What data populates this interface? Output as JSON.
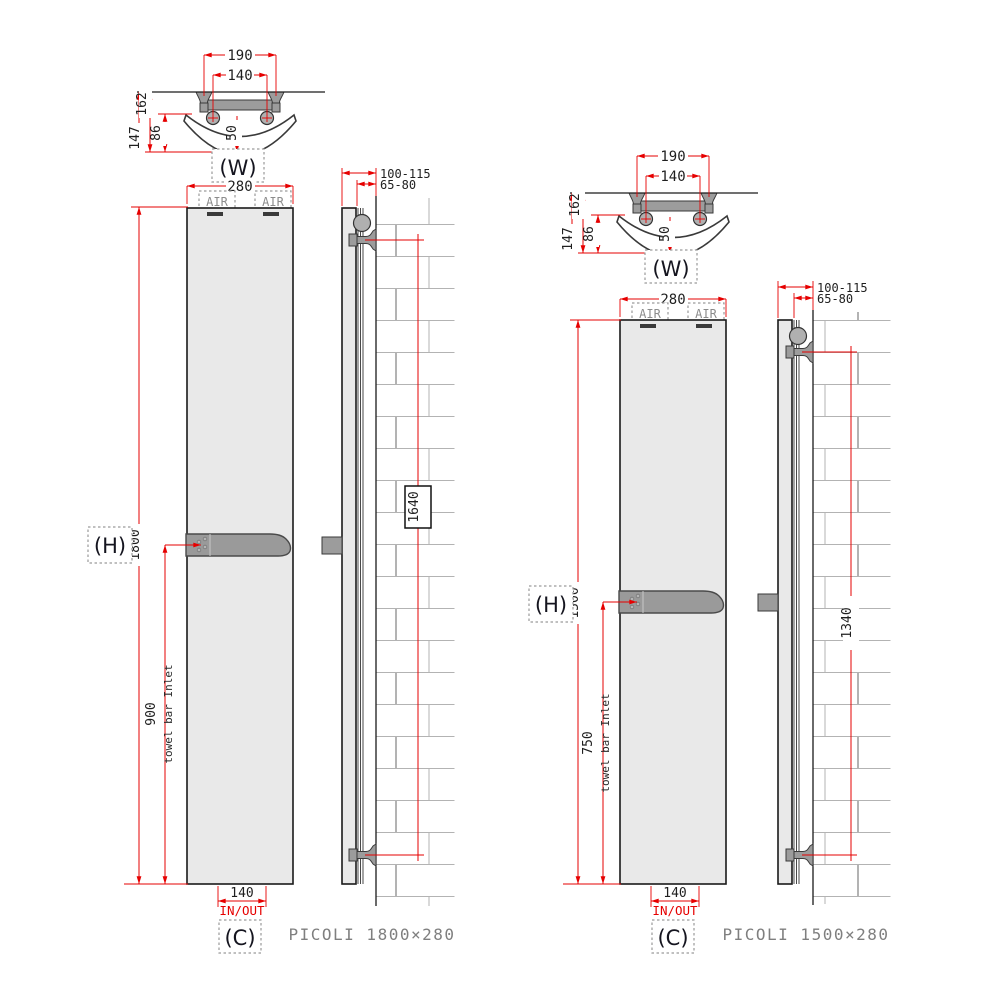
{
  "colors": {
    "dimension_red": "#e60000",
    "panel_gray": "#e9e9e9",
    "hardware_gray": "#9a9a9a",
    "brick_gray": "#b3b3b3",
    "title_gray": "#7f7f7f"
  },
  "drawings": [
    {
      "title": "PICOLI 1800×280",
      "detail": {
        "label": "(W)",
        "dim_bracket_spacing": "190",
        "dim_pipe_spacing": "140",
        "dim_depth_outer": "162",
        "dim_depth_inner": "147",
        "dim_depth_face": "86",
        "dim_thickness": "50"
      },
      "front": {
        "dim_width": "280",
        "air_left": "AIR",
        "air_right": "AIR",
        "height_label": "(H)",
        "dim_height": "1800",
        "dim_towel_bar": "900",
        "towel_note": "towel bar Inlet",
        "dim_inout": "140",
        "inout_label": "IN/OUT",
        "connection_label": "(C)"
      },
      "side": {
        "dim_wall_total": "100-115",
        "dim_wall_gap": "65-80",
        "dim_bracket_span": "1640"
      }
    },
    {
      "title": "PICOLI 1500×280",
      "detail": {
        "label": "(W)",
        "dim_bracket_spacing": "190",
        "dim_pipe_spacing": "140",
        "dim_depth_outer": "162",
        "dim_depth_inner": "147",
        "dim_depth_face": "86",
        "dim_thickness": "50"
      },
      "front": {
        "dim_width": "280",
        "air_left": "AIR",
        "air_right": "AIR",
        "height_label": "(H)",
        "dim_height": "1500",
        "dim_towel_bar": "750",
        "towel_note": "towel bar Inlet",
        "dim_inout": "140",
        "inout_label": "IN/OUT",
        "connection_label": "(C)"
      },
      "side": {
        "dim_wall_total": "100-115",
        "dim_wall_gap": "65-80",
        "dim_bracket_span": "1340"
      }
    }
  ]
}
